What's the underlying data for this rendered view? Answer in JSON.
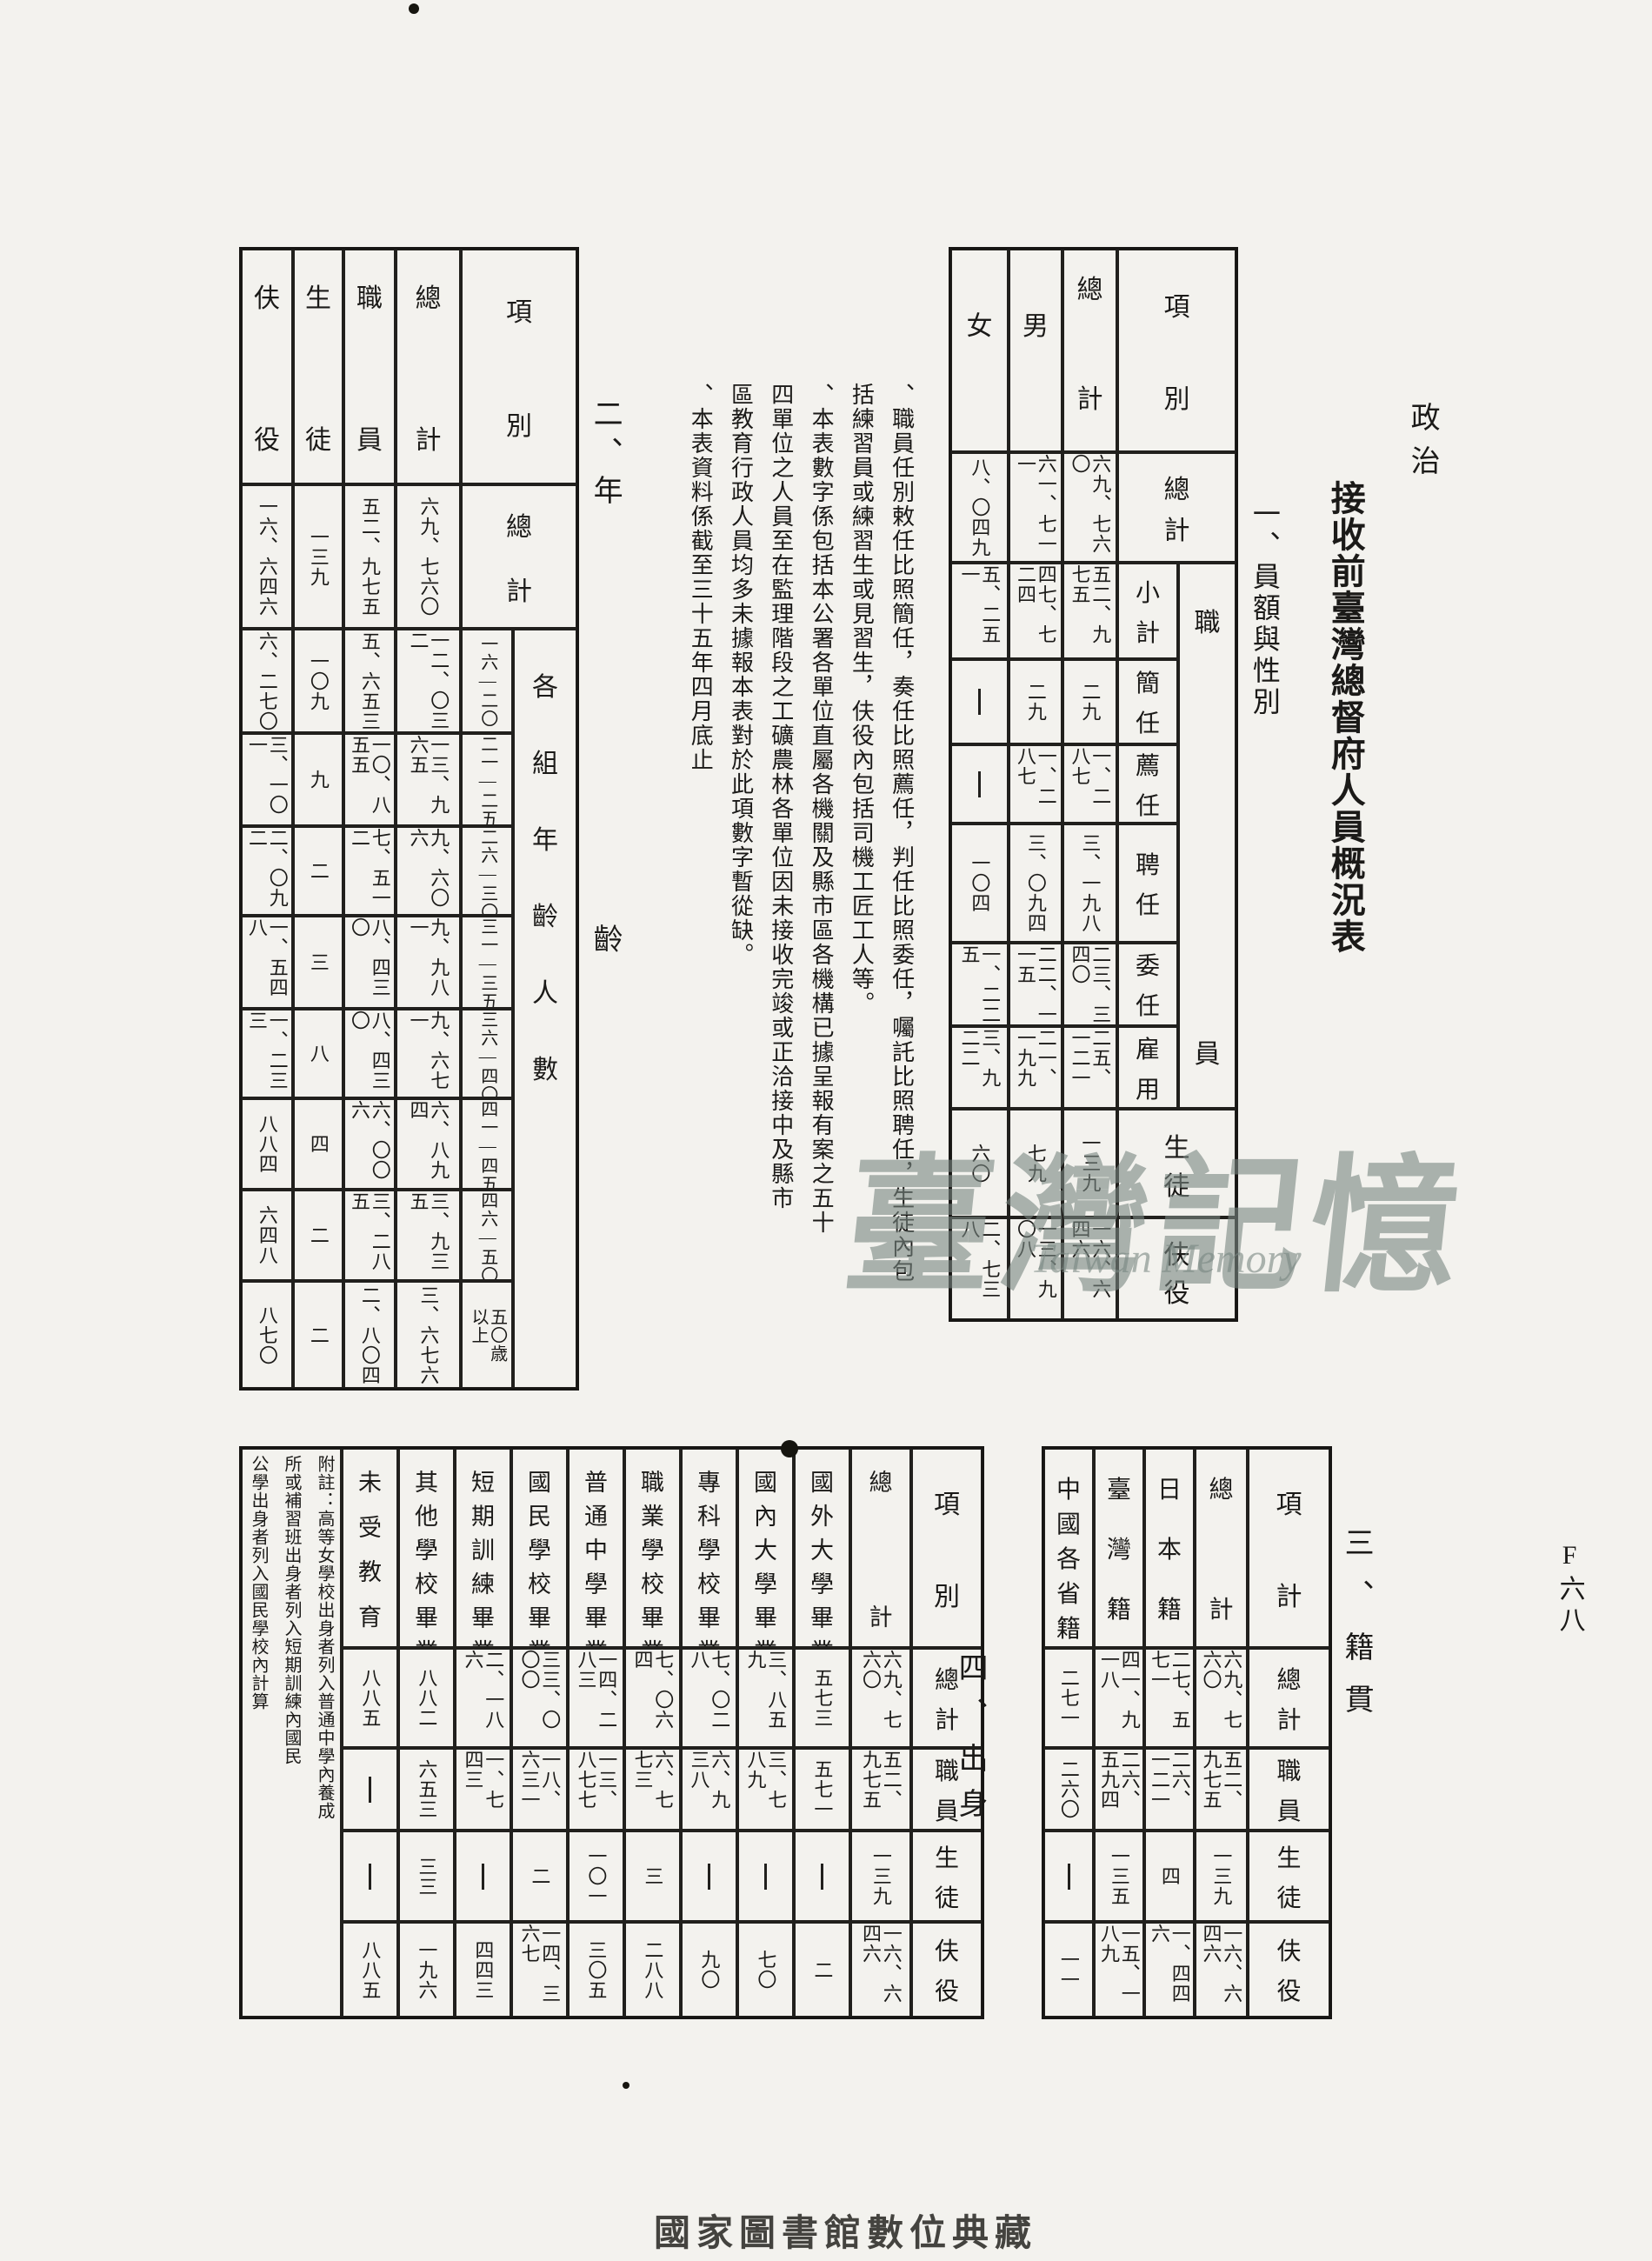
{
  "page": {
    "category_label": "政治",
    "page_number": "F六八",
    "main_title": "接收前臺灣總督府人員概況表",
    "footer": "國家圖書館數位典藏",
    "watermark": {
      "cjk": "臺灣記憶",
      "latin": "Taiwan Memory"
    }
  },
  "notes": {
    "lines": [
      "、職員任別敕任比照簡任，奏任比照薦任，判任比照委任，囑託比照聘任，生徒內包",
      "括練習員或練習生或見習生，伕役內包括司機工匠工人等。",
      "、本表數字係包括本公署各單位直屬各機關及縣市區各機構已據呈報有案之五十",
      "四單位之人員至在監理階段之工礦農林各單位因未接收完竣或正洽接中及縣市",
      "區教育行政人員均多未據報本表對於此項數字暫從缺。",
      "、本表資料係截至三十五年四月底止"
    ]
  },
  "tables": {
    "personnel": {
      "title": "一、員額與性別",
      "corner": "項別",
      "group_label": "職員",
      "col_labels": [
        "總計",
        "男",
        "女"
      ],
      "row_labels": [
        "總計",
        "小計",
        "簡任",
        "薦任",
        "聘任",
        "委任",
        "雇用",
        "生徒",
        "伕役"
      ],
      "rows": [
        [
          "六九、七六〇",
          "六一、七一一",
          "八、〇四九"
        ],
        [
          "五二、九七五",
          "四七、七二四",
          "五、二五一"
        ],
        [
          "二九",
          "二九",
          "—"
        ],
        [
          "一、二八七",
          "一、二八七",
          "—"
        ],
        [
          "三、一九八",
          "三、〇九四",
          "一〇四"
        ],
        [
          "二三、三四〇",
          "二二、一一五",
          "一、二二五"
        ],
        [
          "二五、一二一",
          "二一、一九九",
          "三、九二二"
        ],
        [
          "一三九",
          "七九",
          "六〇"
        ],
        [
          "一六、六四六",
          "一三、九〇八",
          "二、七三八"
        ]
      ]
    },
    "age": {
      "title": "二、年齡",
      "corner": "項別",
      "group_label": "各組年齡人數",
      "col_labels": [
        "總計",
        "職員",
        "生徒",
        "伕役"
      ],
      "row_labels": [
        "總計",
        "一六—二〇",
        "二一—二五",
        "二六—三〇",
        "三一—三五",
        "三六—四〇",
        "四一—四五",
        "四六—五〇",
        "五〇歳以上"
      ],
      "rows": [
        [
          "六九、七六〇",
          "五二、九七五",
          "一三九",
          "一六、六四六"
        ],
        [
          "一二、〇三二",
          "五、六五三",
          "一〇九",
          "六、二七〇"
        ],
        [
          "一三、九六五",
          "一〇、八五五",
          "九",
          "三、一〇一"
        ],
        [
          "九、六〇六",
          "七、五一二",
          "二",
          "二、〇九二"
        ],
        [
          "九、九八一",
          "八、四三〇",
          "三",
          "一、五四八"
        ],
        [
          "九、六七一",
          "八、四三〇",
          "八",
          "一、二三三"
        ],
        [
          "六、八九四",
          "六、〇〇六",
          "四",
          "八八四"
        ],
        [
          "三、九三五",
          "三、二八五",
          "二",
          "六四八"
        ],
        [
          "三、六七六",
          "二、八〇四",
          "二",
          "八七〇"
        ]
      ]
    },
    "origin": {
      "title": "三、籍貫",
      "corner": "項計",
      "col_labels": [
        "總計",
        "日本籍",
        "臺灣籍",
        "中國各省籍"
      ],
      "row_labels": [
        "總計",
        "職員",
        "生徒",
        "伕役"
      ],
      "rows": [
        [
          "六九、七六〇",
          "二七、五七一",
          "四一、九一八",
          "二七一"
        ],
        [
          "五二、九七五",
          "二六、一二一",
          "二六、五九四",
          "二六〇"
        ],
        [
          "一三九",
          "四",
          "一三五",
          "—"
        ],
        [
          "一六、六四六",
          "一、四四六",
          "一五、一八九",
          "一一"
        ]
      ]
    },
    "education": {
      "title": "四、出身",
      "corner": "項別",
      "col_labels": [
        "總計",
        "國外大學畢業",
        "國內大學畢業",
        "專科學校畢業",
        "職業學校畢業",
        "普通中學畢業",
        "國民學校畢業",
        "短期訓練畢業",
        "其他學校畢業",
        "未受教育"
      ],
      "row_labels": [
        "總計",
        "職員",
        "生徒",
        "伕役"
      ],
      "note_lines": [
        "附註：高等女學校出身者列入普通中學內養成",
        "所或補習班出身者列入短期訓練內國民",
        "公學出身者列入國民學校內計算"
      ],
      "rows": [
        [
          "六九、七六〇",
          "五七三",
          "三、八五九",
          "七、〇二八",
          "七、〇六四",
          "一四、二八三",
          "三三、〇〇〇",
          "二、一八六",
          "八八二",
          "八八五"
        ],
        [
          "五二、九七五",
          "五七一",
          "三、七八九",
          "六、九三八",
          "六、七七三",
          "一三、八七七",
          "一八、六三一",
          "一、七四三",
          "六五三",
          "—"
        ],
        [
          "一三九",
          "—",
          "—",
          "—",
          "三",
          "一〇一",
          "二",
          "—",
          "三三",
          "—"
        ],
        [
          "一六、六四六",
          "二",
          "七〇",
          "九〇",
          "二八八",
          "三〇五",
          "一四、三六七",
          "四四三",
          "一九六",
          "八八五"
        ]
      ]
    }
  }
}
